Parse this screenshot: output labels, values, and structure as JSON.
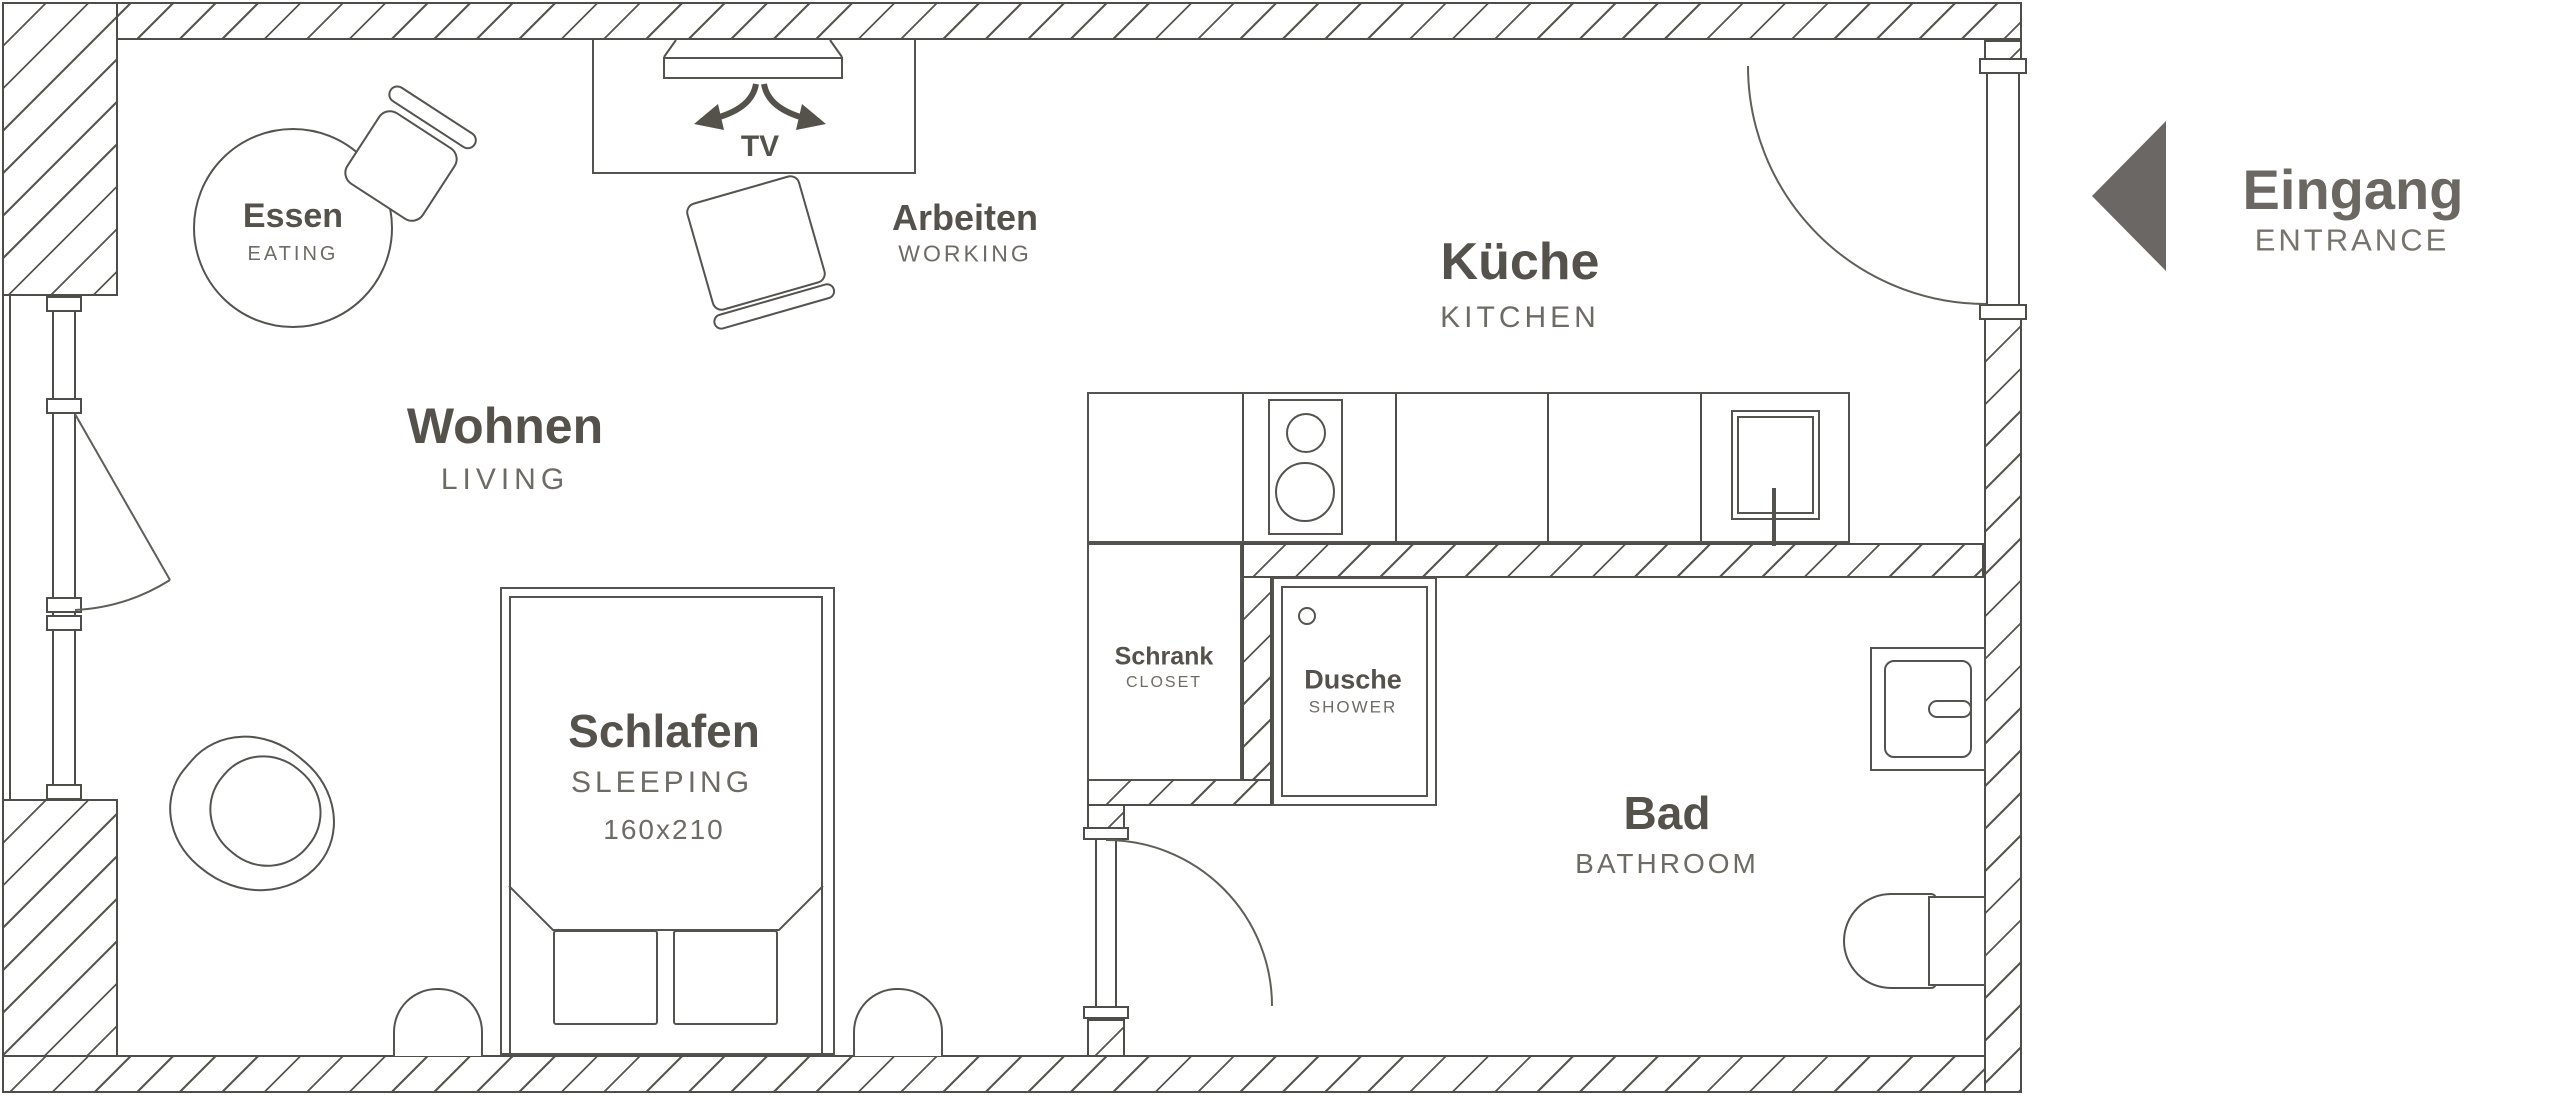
{
  "plan": {
    "rooms": {
      "eating": {
        "de": "Essen",
        "en": "EATING"
      },
      "living": {
        "de": "Wohnen",
        "en": "LIVING"
      },
      "working": {
        "de": "Arbeiten",
        "en": "WORKING"
      },
      "kitchen": {
        "de": "Küche",
        "en": "KITCHEN"
      },
      "sleeping": {
        "de": "Schlafen",
        "en": "SLEEPING",
        "size": "160x210"
      },
      "closet": {
        "de": "Schrank",
        "en": "CLOSET"
      },
      "shower": {
        "de": "Dusche",
        "en": "SHOWER"
      },
      "bathroom": {
        "de": "Bad",
        "en": "BATHROOM"
      },
      "entrance": {
        "de": "Eingang",
        "en": "ENTRANCE"
      }
    },
    "tv_label": "TV",
    "colors": {
      "wall_line": "#4e4d49",
      "furniture_line": "#55534f",
      "label_bold": "#55524b",
      "label_sub": "#6e6b65",
      "entrance_arrow": "#6a6764"
    }
  }
}
